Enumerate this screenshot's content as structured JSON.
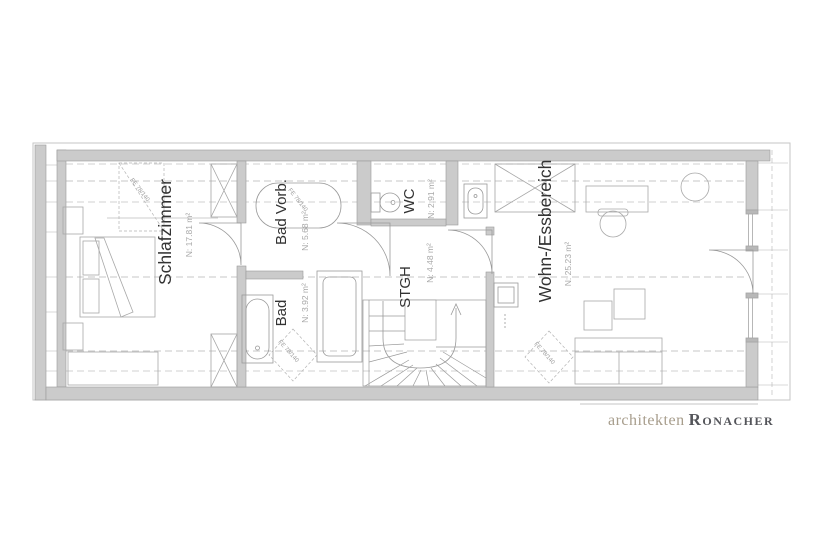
{
  "plan": {
    "rooms": [
      {
        "id": "schlafzimmer",
        "label": "Schlafzimmer",
        "area": "N: 17.81 m²"
      },
      {
        "id": "bad-vorb",
        "label": "Bad Vorb.",
        "area": "N: 5.68 m²"
      },
      {
        "id": "wc",
        "label": "WC",
        "area": "N: 2.91 m²"
      },
      {
        "id": "stgh",
        "label": "STGH",
        "area": "N: 4.48 m²"
      },
      {
        "id": "bad",
        "label": "Bad",
        "area": "N: 3.92 m²"
      },
      {
        "id": "wohn-essbereich",
        "label": "Wohn-/Essbereich",
        "area": "N: 25.23 m²"
      }
    ],
    "annotations": {
      "roof_window": "FE 78/140"
    }
  },
  "branding": {
    "studio": "architekten",
    "name": "Ronacher"
  },
  "colors": {
    "wall_fill": "#cbcbcb",
    "line": "#9a9a9a",
    "dashed_line": "#bfbfbf",
    "room_label": "#333333",
    "area_label": "#a8a8a8",
    "logo_studio": "#a79d8c",
    "logo_name": "#54555a"
  }
}
